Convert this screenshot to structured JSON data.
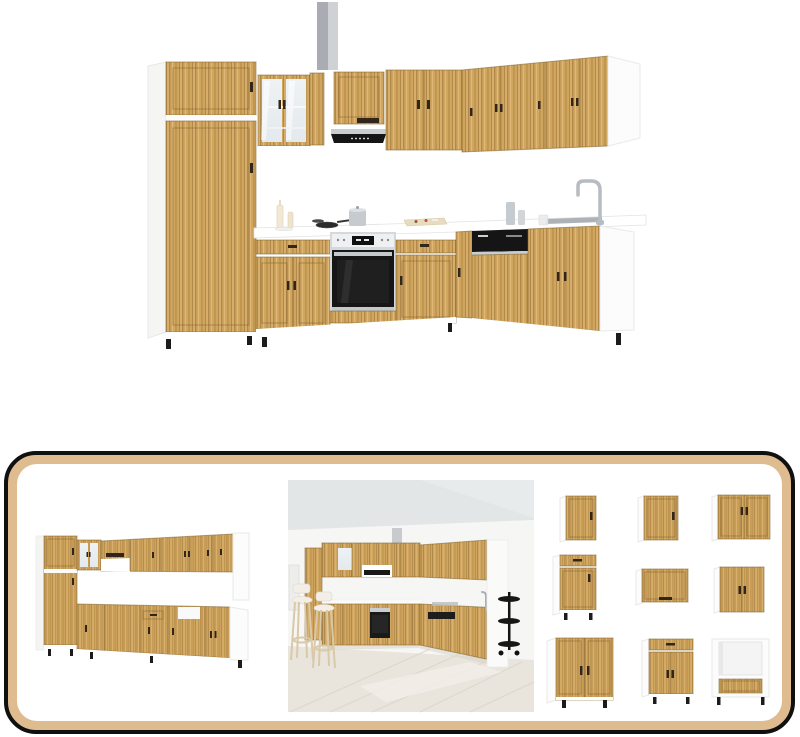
{
  "page": {
    "background": "#ffffff",
    "image_count": 4,
    "module_count": 9
  },
  "colors": {
    "wood_base": "#cfa55f",
    "wood_mid": "#c1974f",
    "wood_dark": "#b1894a",
    "wood_light": "#e2bc7a",
    "carcass_white": "#fcfcfc",
    "panel_tan": "#dfbb90",
    "panel_border": "#101010",
    "flue_dark": "#a9adb3",
    "flue_light": "#cfd2d5",
    "steel": "#c9ced2",
    "appliance_black": "#151515",
    "handle_dark": "#32261a",
    "glass": "#e3e9ed",
    "ceiling_gray": "#e2e6e7",
    "wall_white": "#f6f6f5",
    "floor_wood": "#e9e5dd",
    "floor_line": "#dcd6cb",
    "foot_black": "#1c1c1c"
  },
  "main_image": {
    "name": "kitchen-set-main-view",
    "features": [
      "tall-pantry-cabinet",
      "glass-display-cabinet",
      "extractor-hood",
      "built-in-oven",
      "dishwasher",
      "sink-and-faucet",
      "corner-l-shape"
    ]
  },
  "gallery": {
    "views": [
      {
        "name": "kitchen-set-alternate-angle"
      },
      {
        "name": "kitchen-lifestyle-room"
      },
      {
        "name": "cabinet-modules-grid"
      }
    ],
    "modules": [
      {
        "name": "wall-cabinet-single-door-narrow"
      },
      {
        "name": "wall-cabinet-single-door"
      },
      {
        "name": "wall-cabinet-double-door-wide"
      },
      {
        "name": "base-cabinet-drawer-and-door"
      },
      {
        "name": "wall-cabinet-flip-up"
      },
      {
        "name": "wall-cabinet-double-door"
      },
      {
        "name": "base-cabinet-double-door-wide"
      },
      {
        "name": "base-cabinet-drawer-double-door"
      },
      {
        "name": "oven-housing-cabinet"
      }
    ]
  }
}
